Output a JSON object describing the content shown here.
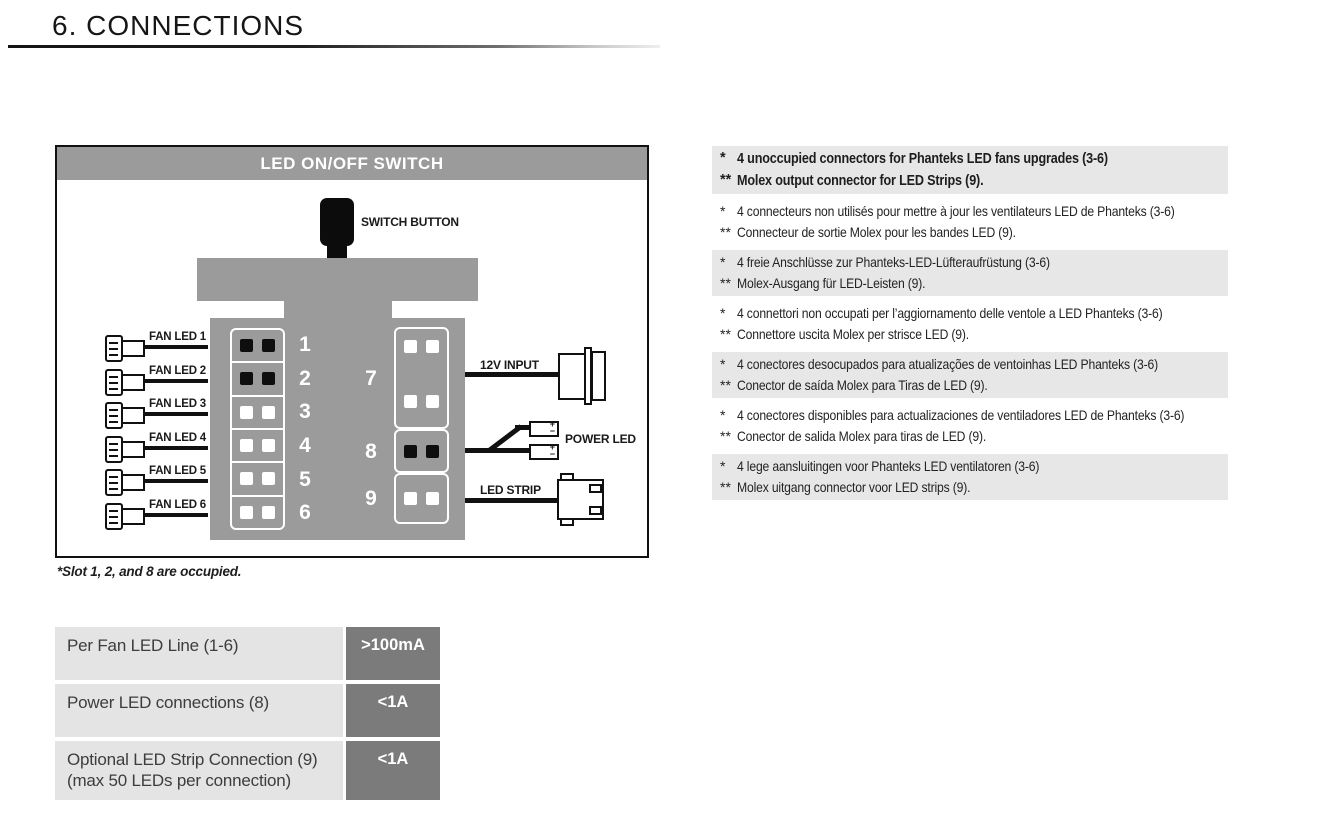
{
  "header": {
    "title": "6. CONNECTIONS"
  },
  "diagram": {
    "title": "LED ON/OFF SWITCH",
    "switch_label": "SWITCH BUTTON",
    "fan_labels": [
      "FAN LED 1",
      "FAN LED 2",
      "FAN LED 3",
      "FAN LED 4",
      "FAN LED 5",
      "FAN LED 6"
    ],
    "slot_numbers_left": [
      "1",
      "2",
      "3",
      "4",
      "5",
      "6"
    ],
    "slot_numbers_right": [
      "7",
      "8",
      "9"
    ],
    "occupied_slots": [
      1,
      2,
      8
    ],
    "labels": {
      "input": "12V INPUT",
      "power": "POWER LED",
      "strip": "LED STRIP"
    },
    "polarity": {
      "plus": "+",
      "minus": "−"
    },
    "footnote": "*Slot 1, 2, and 8 are occupied."
  },
  "table": {
    "rows": [
      {
        "label": "Per Fan LED Line (1-6)",
        "label2": "",
        "value": ">100mA"
      },
      {
        "label": "Power LED connections (8)",
        "label2": "",
        "value": "<1A"
      },
      {
        "label": "Optional LED Strip Connection (9)",
        "label2": "(max 50 LEDs per connection)",
        "value": "<1A"
      }
    ]
  },
  "notes": [
    {
      "lang": "english",
      "shaded": true,
      "bold": true,
      "lines": [
        {
          "marker": "*",
          "text": "4 unoccupied connectors for Phanteks LED fans upgrades (3-6)"
        },
        {
          "marker": "**",
          "text": "Molex output connector for LED Strips (9)."
        }
      ]
    },
    {
      "lang": "french",
      "shaded": false,
      "bold": false,
      "lines": [
        {
          "marker": "*",
          "text": "4 connecteurs non utilisés pour mettre à jour les ventilateurs LED de Phanteks (3-6)"
        },
        {
          "marker": "**",
          "text": "Connecteur de sortie Molex pour les bandes LED (9)."
        }
      ]
    },
    {
      "lang": "german",
      "shaded": true,
      "bold": false,
      "lines": [
        {
          "marker": "*",
          "text": "4 freie Anschlüsse zur Phanteks-LED-Lüfteraufrüstung (3-6)"
        },
        {
          "marker": "**",
          "text": "Molex-Ausgang für LED-Leisten (9)."
        }
      ]
    },
    {
      "lang": "italian",
      "shaded": false,
      "bold": false,
      "lines": [
        {
          "marker": "*",
          "text": "4 connettori non occupati per l’aggiornamento delle ventole a LED Phanteks (3-6)"
        },
        {
          "marker": "**",
          "text": "Connettore uscita Molex per strisce LED (9)."
        }
      ]
    },
    {
      "lang": "portuguese",
      "shaded": true,
      "bold": false,
      "lines": [
        {
          "marker": "*",
          "text": "4 conectores desocupados para atualizações de ventoinhas LED Phanteks (3-6)"
        },
        {
          "marker": "**",
          "text": "Conector de saída Molex para Tiras de LED (9)."
        }
      ]
    },
    {
      "lang": "spanish",
      "shaded": false,
      "bold": false,
      "lines": [
        {
          "marker": "*",
          "text": "4 conectores disponibles para actualizaciones de ventiladores LED de Phanteks (3-6)"
        },
        {
          "marker": "**",
          "text": "Conector de salida Molex para tiras de LED (9)."
        }
      ]
    },
    {
      "lang": "dutch",
      "shaded": true,
      "bold": false,
      "lines": [
        {
          "marker": "*",
          "text": "4 lege aansluitingen voor Phanteks LED ventilatoren (3-6)"
        },
        {
          "marker": "**",
          "text": "Molex uitgang connector voor LED strips (9)."
        }
      ]
    }
  ],
  "colors": {
    "diagram_gray": "#9b9b9b",
    "table_label_bg": "#e4e4e4",
    "table_value_bg": "#7b7b7b",
    "note_stripe_bg": "#e7e7e7",
    "ink": "#111111"
  }
}
